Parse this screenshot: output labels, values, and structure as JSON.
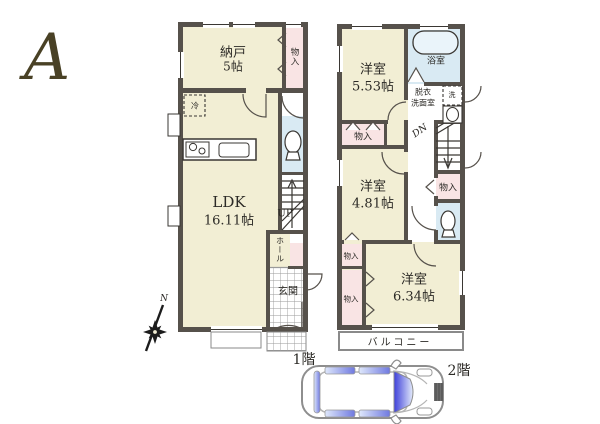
{
  "plan_letter": "A",
  "compass": {
    "north_label": "N"
  },
  "floor1": {
    "floor_label": "1階",
    "nando": {
      "name": "納戸",
      "size": "5帖"
    },
    "ldk": {
      "name": "LDK",
      "size": "16.11帖"
    },
    "closet_top": "物入",
    "fridge": "冷",
    "stairs_up": "UP",
    "hall": "ホール",
    "entrance": "玄関"
  },
  "floor2": {
    "floor_label": "2階",
    "room_553": {
      "name": "洋室",
      "size": "5.53帖"
    },
    "room_481": {
      "name": "洋室",
      "size": "4.81帖"
    },
    "room_634": {
      "name": "洋室",
      "size": "6.34帖"
    },
    "bath": "浴室",
    "washroom_line1": "脱衣",
    "washroom_line2": "洗面室",
    "washer": "洗",
    "closet_a": "物入",
    "closet_b": "物入",
    "closet_c": "物入",
    "closet_d": "物入",
    "stairs_down": "DN",
    "balcony": "バルコニー"
  },
  "colors": {
    "wall": "#56514b",
    "room_cream": "#f2eed4",
    "closet_pink": "#f9e4e4",
    "wet_blue": "#d9eaf3",
    "letter": "#494125"
  }
}
